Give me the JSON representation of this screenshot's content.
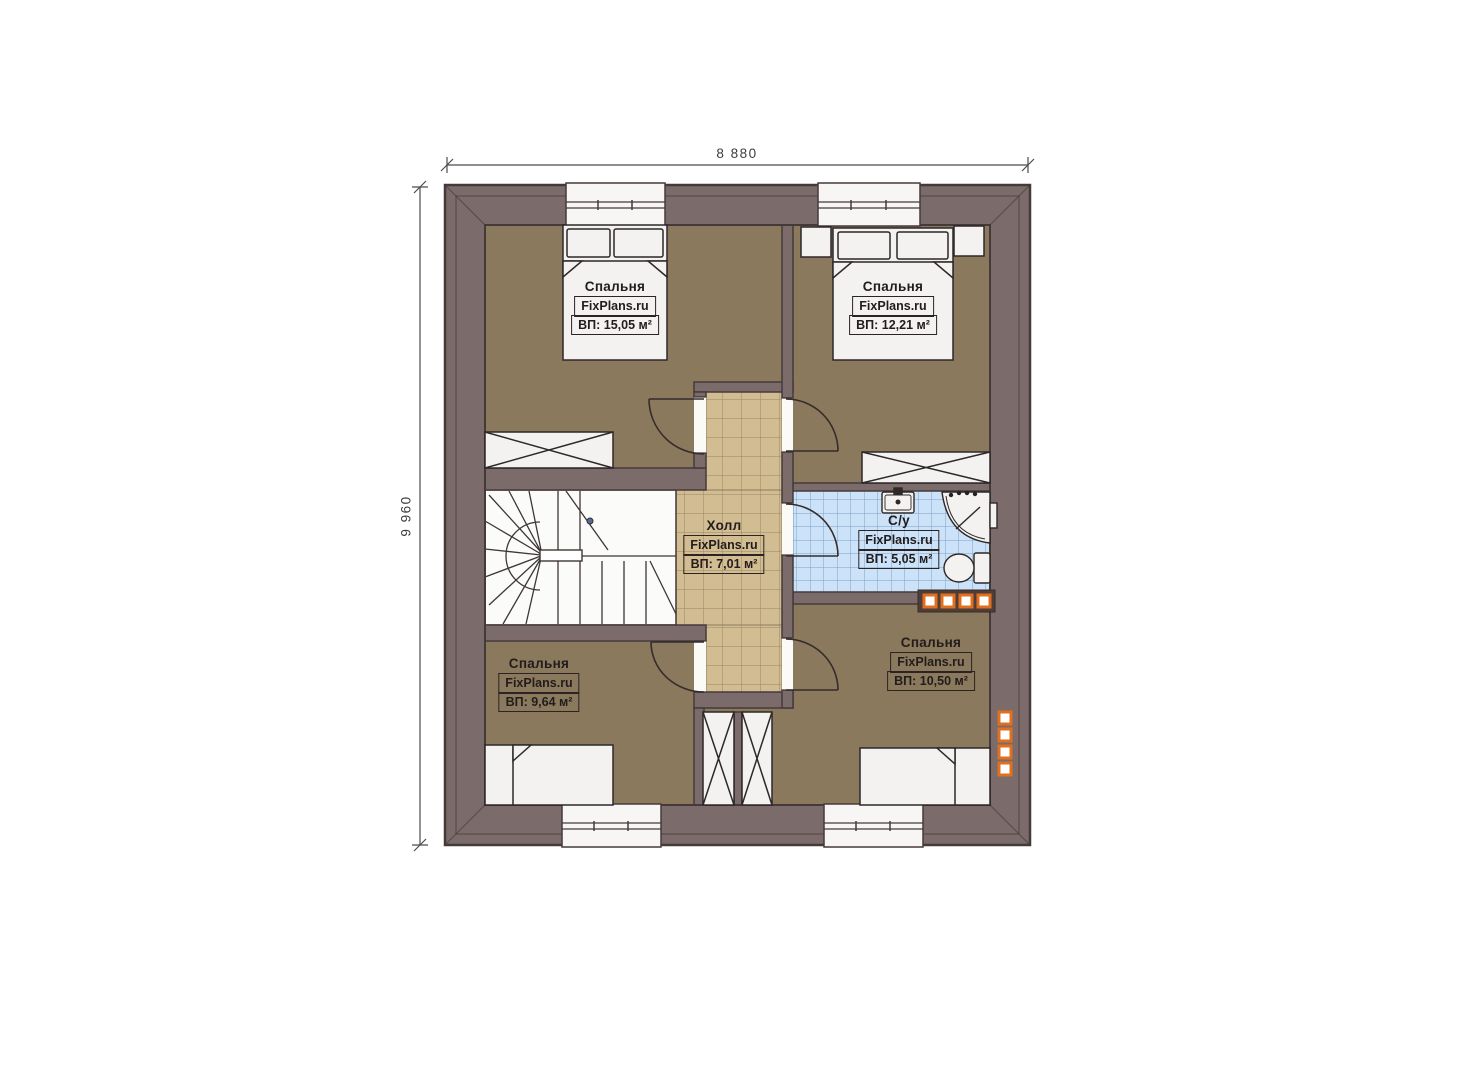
{
  "plan": {
    "type": "floor-plan",
    "dimensions": {
      "width": "8 880",
      "height": "9 960"
    },
    "rooms": [
      {
        "id": "bedroom-top-left",
        "name": "Спальня",
        "brand": "FixPlans.ru",
        "area": "ВП: 15,05 м²"
      },
      {
        "id": "bedroom-top-right",
        "name": "Спальня",
        "brand": "FixPlans.ru",
        "area": "ВП: 12,21 м²"
      },
      {
        "id": "hall",
        "name": "Холл",
        "brand": "FixPlans.ru",
        "area": "ВП: 7,01 м²"
      },
      {
        "id": "bathroom",
        "name": "С/у",
        "brand": "FixPlans.ru",
        "area": "ВП: 5,05 м²"
      },
      {
        "id": "bedroom-bottom-left",
        "name": "Спальня",
        "brand": "FixPlans.ru",
        "area": "ВП: 9,64 м²"
      },
      {
        "id": "bedroom-bottom-right",
        "name": "Спальня",
        "brand": "FixPlans.ru",
        "area": "ВП: 10,50 м²"
      }
    ],
    "colors": {
      "wall": "#7c6b6b",
      "bedroom_floor": "#8a795c",
      "hall_tile": "#d2bd92",
      "bathroom_tile": "#cbe2f8",
      "radiator_accent": "#e0701f"
    }
  }
}
